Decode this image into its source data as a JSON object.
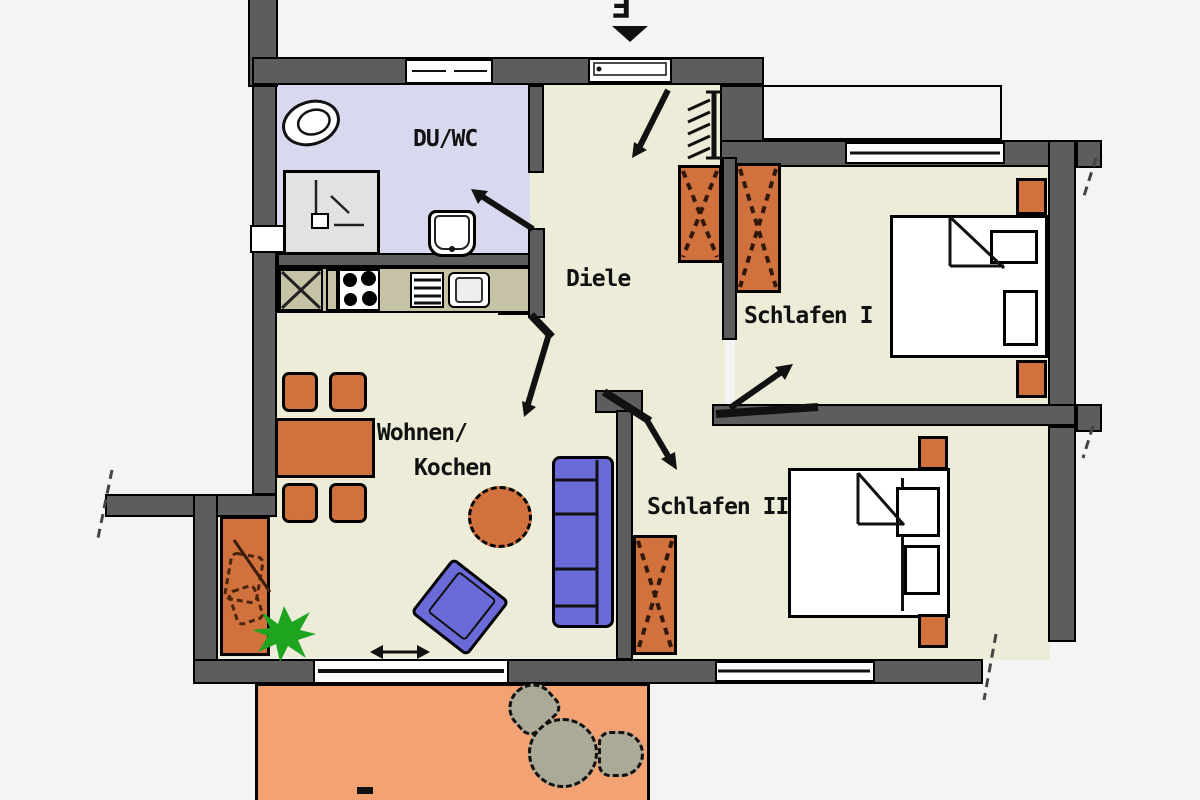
{
  "title": "Apartment floor plan with two bedrooms and terrace",
  "labels": {
    "entrance_letter": "E",
    "bathroom": "DU/WC",
    "hallway": "Diele",
    "bedroom1": "Schlafen I",
    "bedroom2": "Schlafen II",
    "living_line1": "Wohnen/",
    "living_line2": "Kochen",
    "terrace_partial": "T"
  },
  "rooms": [
    {
      "id": "du-wc",
      "label": "DU/WC",
      "type": "shower-bathroom",
      "fixtures": [
        "toilet",
        "shower",
        "washbasin"
      ]
    },
    {
      "id": "diele",
      "label": "Diele",
      "type": "hallway",
      "fixtures": [
        "coat-rack",
        "wardrobe"
      ]
    },
    {
      "id": "schlafen-1",
      "label": "Schlafen I",
      "type": "bedroom",
      "fixtures": [
        "double-bed",
        "nightstand",
        "nightstand",
        "wardrobe",
        "window"
      ]
    },
    {
      "id": "schlafen-2",
      "label": "Schlafen II",
      "type": "bedroom",
      "fixtures": [
        "double-bed",
        "nightstand",
        "nightstand",
        "wardrobe",
        "window"
      ]
    },
    {
      "id": "wohnen-kochen",
      "label": "Wohnen/Kochen",
      "type": "living-kitchen",
      "fixtures": [
        "kitchenette",
        "stove",
        "kitchen-sink",
        "dining-table",
        "chair",
        "chair",
        "chair",
        "chair",
        "sofa",
        "armchair",
        "coffee-table",
        "sideboard",
        "plant",
        "balcony-door",
        "window"
      ]
    },
    {
      "id": "terrasse",
      "label": "T",
      "type": "terrace",
      "fixtures": [
        "garden-table",
        "garden-chair",
        "garden-chair"
      ]
    }
  ],
  "symbols": {
    "entrance_arrow": "door swing into hallway",
    "door_arrows": 5,
    "section_cut_marks": 4,
    "sliding_door_arrow": "double-headed arrow at balcony door"
  },
  "colors": {
    "wall": "#5d5d5d",
    "outline": "#000000",
    "floor": "#edecd9",
    "bath_floor": "#d8d8ef",
    "counter": "#c6c2a6",
    "furniture_orange": "#d0713e",
    "terrace": "#f2a273",
    "upholstery_blue": "#6a6ad9",
    "terrace_furniture": "#abaa96",
    "plant": "#1ea41e",
    "outside": "#f4f4f2"
  }
}
